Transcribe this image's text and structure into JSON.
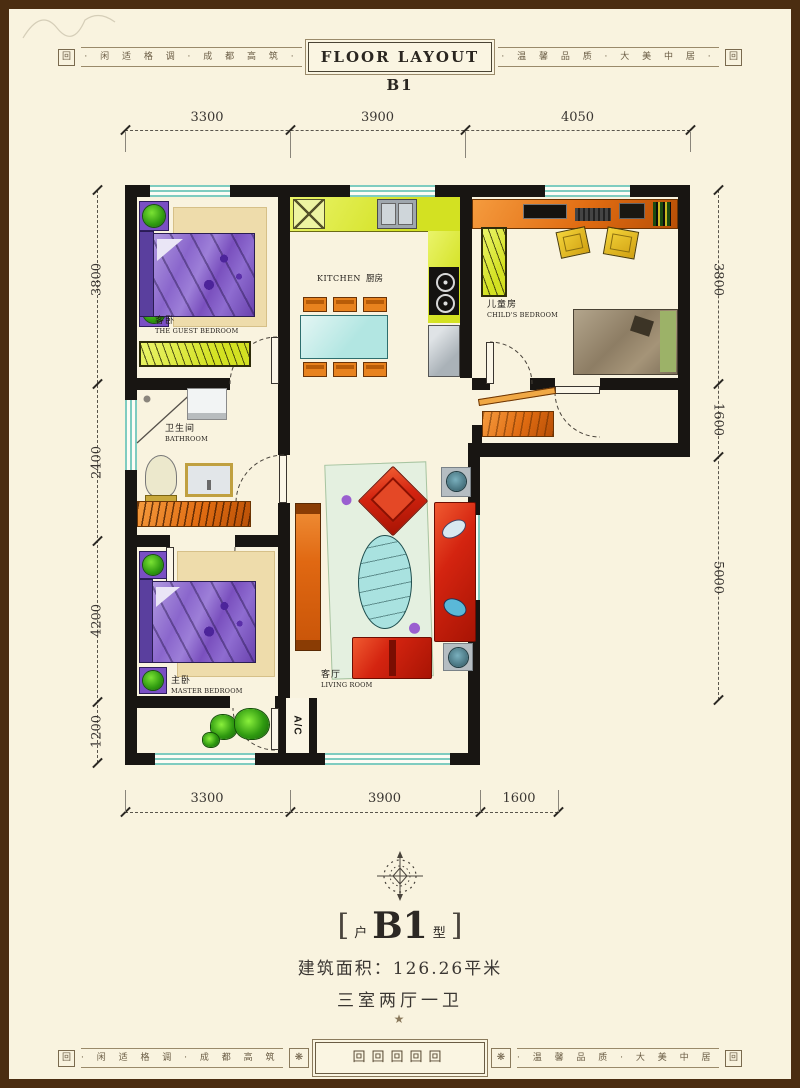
{
  "band": {
    "title": "FLOOR LAYOUT B1",
    "corner_glyph": "回",
    "left_text": "· 闲 适 格 调 · 成 都 高 筑 ·",
    "right_text": "· 温 馨 品 质 · 大 美 中 居 ·",
    "center_glyphs": "回回回回回",
    "flower": "❋"
  },
  "dimensions": {
    "top": [
      "3300",
      "3900",
      "4050"
    ],
    "left": [
      "3800",
      "2400",
      "4200",
      "1200"
    ],
    "right": [
      "3800",
      "1600",
      "5000"
    ],
    "bottom": [
      "3300",
      "3900",
      "1600"
    ]
  },
  "rooms": {
    "guest": {
      "zh": "客卧",
      "en": "THE GUEST BEDROOM"
    },
    "kitchen": {
      "en": "KITCHEN",
      "zh": "厨房"
    },
    "child": {
      "zh": "儿童房",
      "en": "CHILD'S BEDROOM"
    },
    "bath": {
      "zh": "卫生间",
      "en": "BATHROOM"
    },
    "master": {
      "zh": "主卧",
      "en": "MASTER BEDROOM"
    },
    "living": {
      "zh": "客厅",
      "en": "LIVING ROOM"
    },
    "ac": "A/C"
  },
  "summary": {
    "bracket_l": "[",
    "unit_prefix": "户",
    "unit_name": "B1",
    "unit_suffix": "型",
    "bracket_r": "]",
    "area": "建筑面积：126.26平米",
    "rooms_desc": "三室两厅一卫",
    "star": "★"
  },
  "colors": {
    "wall": "#181512",
    "window_teal": "#7fccc0",
    "accent_red": "#d42410",
    "accent_orange": "#e06c12",
    "accent_purple": "#8a66cc",
    "accent_yellowgreen": "#dfe93c",
    "paper": "#f9f3df",
    "frame_brown": "#4b2d11"
  }
}
